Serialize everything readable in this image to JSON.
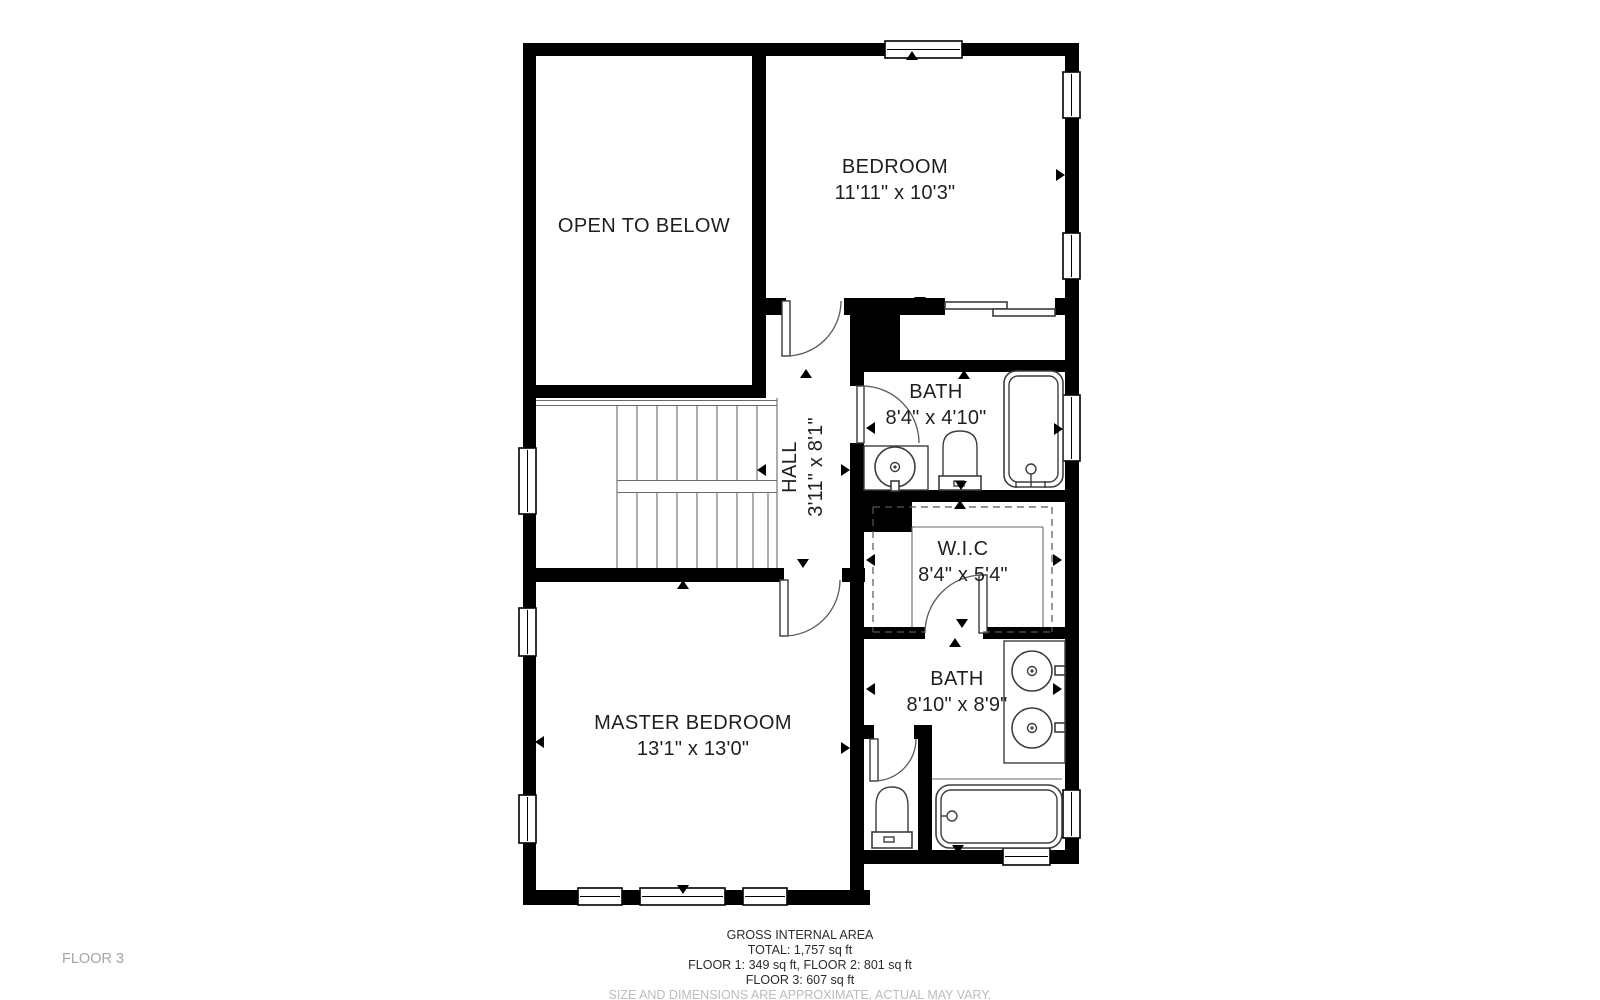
{
  "floor_tag": "FLOOR 3",
  "rooms": [
    {
      "id": "open-to-below",
      "name": "OPEN TO BELOW",
      "dims": ""
    },
    {
      "id": "bedroom",
      "name": "BEDROOM",
      "dims": "11'11\" x 10'3\""
    },
    {
      "id": "bath-upper",
      "name": "BATH",
      "dims": "8'4\" x 4'10\""
    },
    {
      "id": "hall",
      "name": "HALL",
      "dims": "3'11\" x 8'1\""
    },
    {
      "id": "wic",
      "name": "W.I.C",
      "dims": "8'4\" x 5'4\""
    },
    {
      "id": "bath-master",
      "name": "BATH",
      "dims": "8'10\" x 8'9\""
    },
    {
      "id": "master-bedroom",
      "name": "MASTER BEDROOM",
      "dims": "13'1\" x 13'0\""
    }
  ],
  "footer": {
    "title": "GROSS INTERNAL AREA",
    "total": "TOTAL: 1,757 sq ft",
    "floors_1_2": "FLOOR 1: 349 sq ft, FLOOR 2: 801 sq ft",
    "floor_3": "FLOOR 3: 607 sq ft",
    "disclaimer": "SIZE AND DIMENSIONS ARE APPROXIMATE, ACTUAL MAY VARY."
  },
  "colors": {
    "wall": "#000000",
    "line": "#3d3d3d",
    "background": "#ffffff",
    "label": "#1f1f1f",
    "muted": "#bcbcbc",
    "floor_tag": "#a6a6a6"
  }
}
